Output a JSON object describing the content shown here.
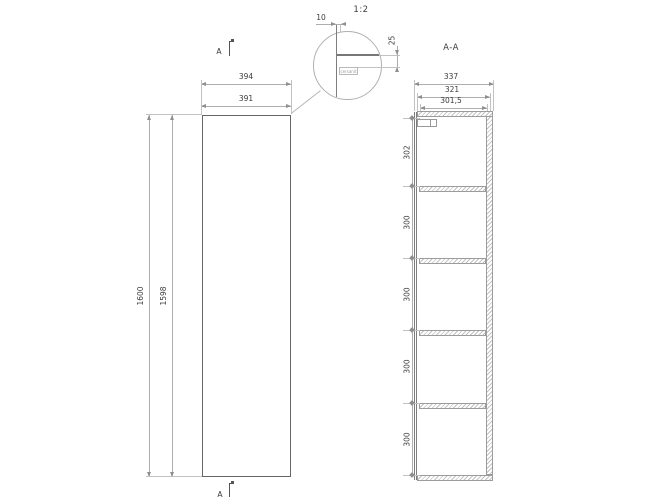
{
  "front_view": {
    "section_marker_top": "A",
    "section_marker_bottom": "A",
    "dims": {
      "width_outer": "394",
      "width_inner": "391",
      "height_outer": "1600",
      "height_inner": "1598"
    }
  },
  "detail_view": {
    "scale": "1:2",
    "dims": {
      "gap": "10",
      "top_overhang": "25"
    },
    "brand": "cersanit"
  },
  "section_view": {
    "title": "A-A",
    "dims": {
      "depth_outer": "337",
      "depth_carcass": "321",
      "depth_inner": "301,5",
      "spacing": [
        "302",
        "300",
        "300",
        "300",
        "300"
      ]
    }
  }
}
